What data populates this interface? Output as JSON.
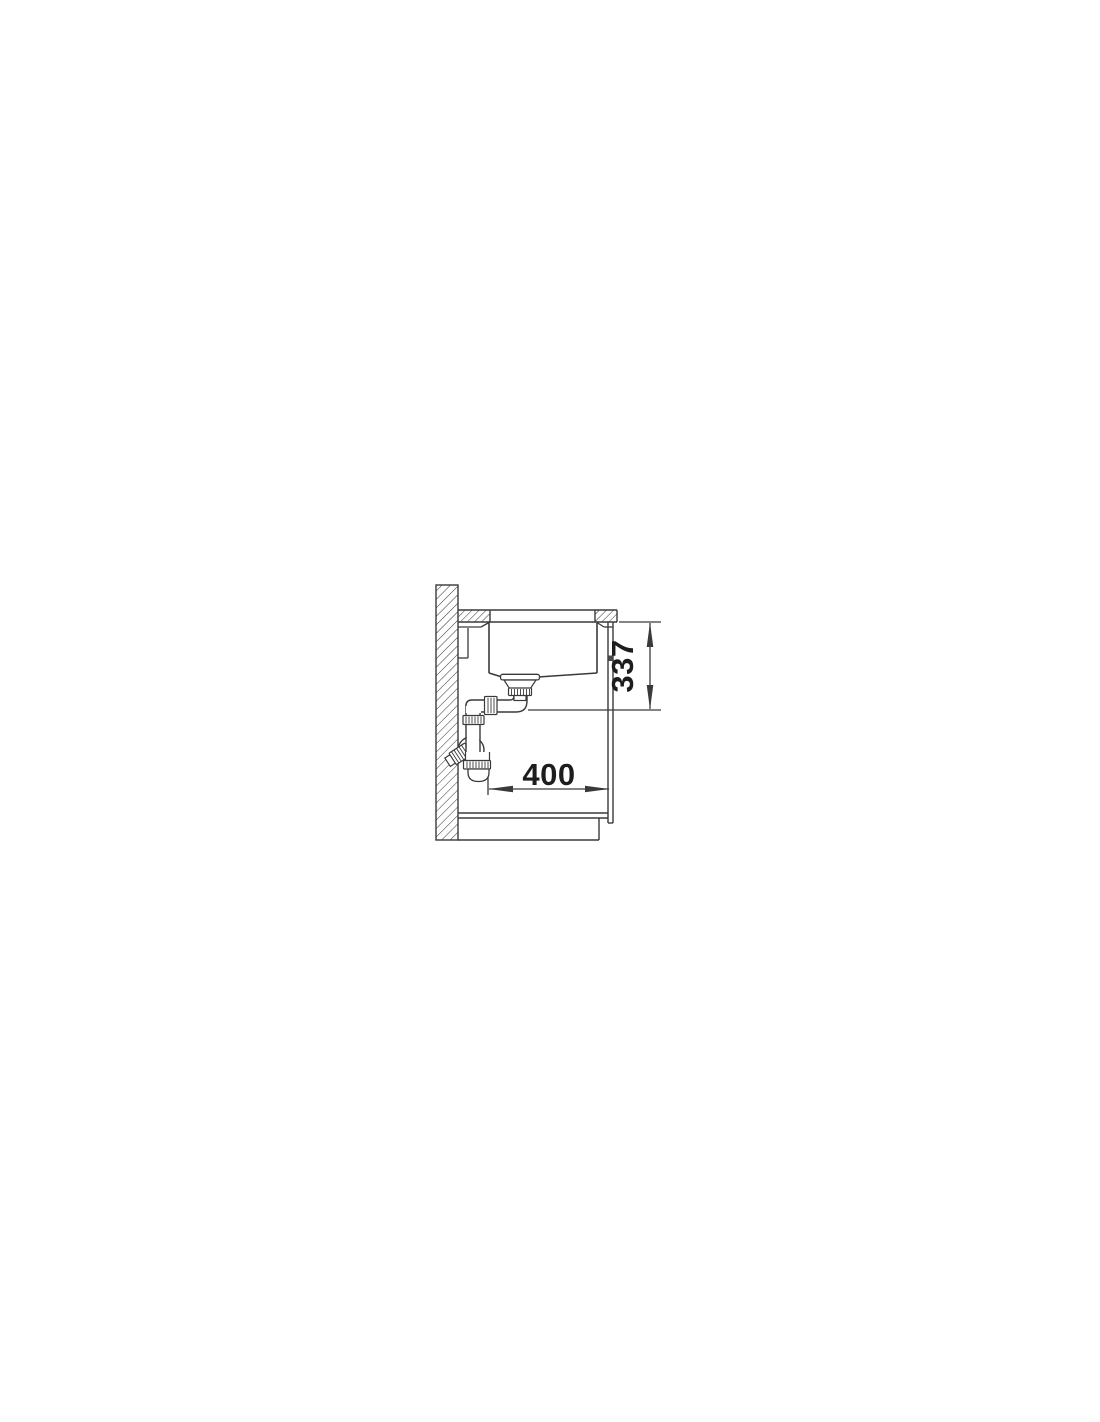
{
  "page": {
    "background": "#ffffff"
  },
  "drawing": {
    "kind": "technical-section-drawing",
    "subject": "undermount-sink-cabinet-side-section",
    "line_color": "#3a3a3a",
    "label_color": "#1d1d1d",
    "labels": {
      "vertical_dimension": "337",
      "horizontal_dimension": "400"
    }
  }
}
